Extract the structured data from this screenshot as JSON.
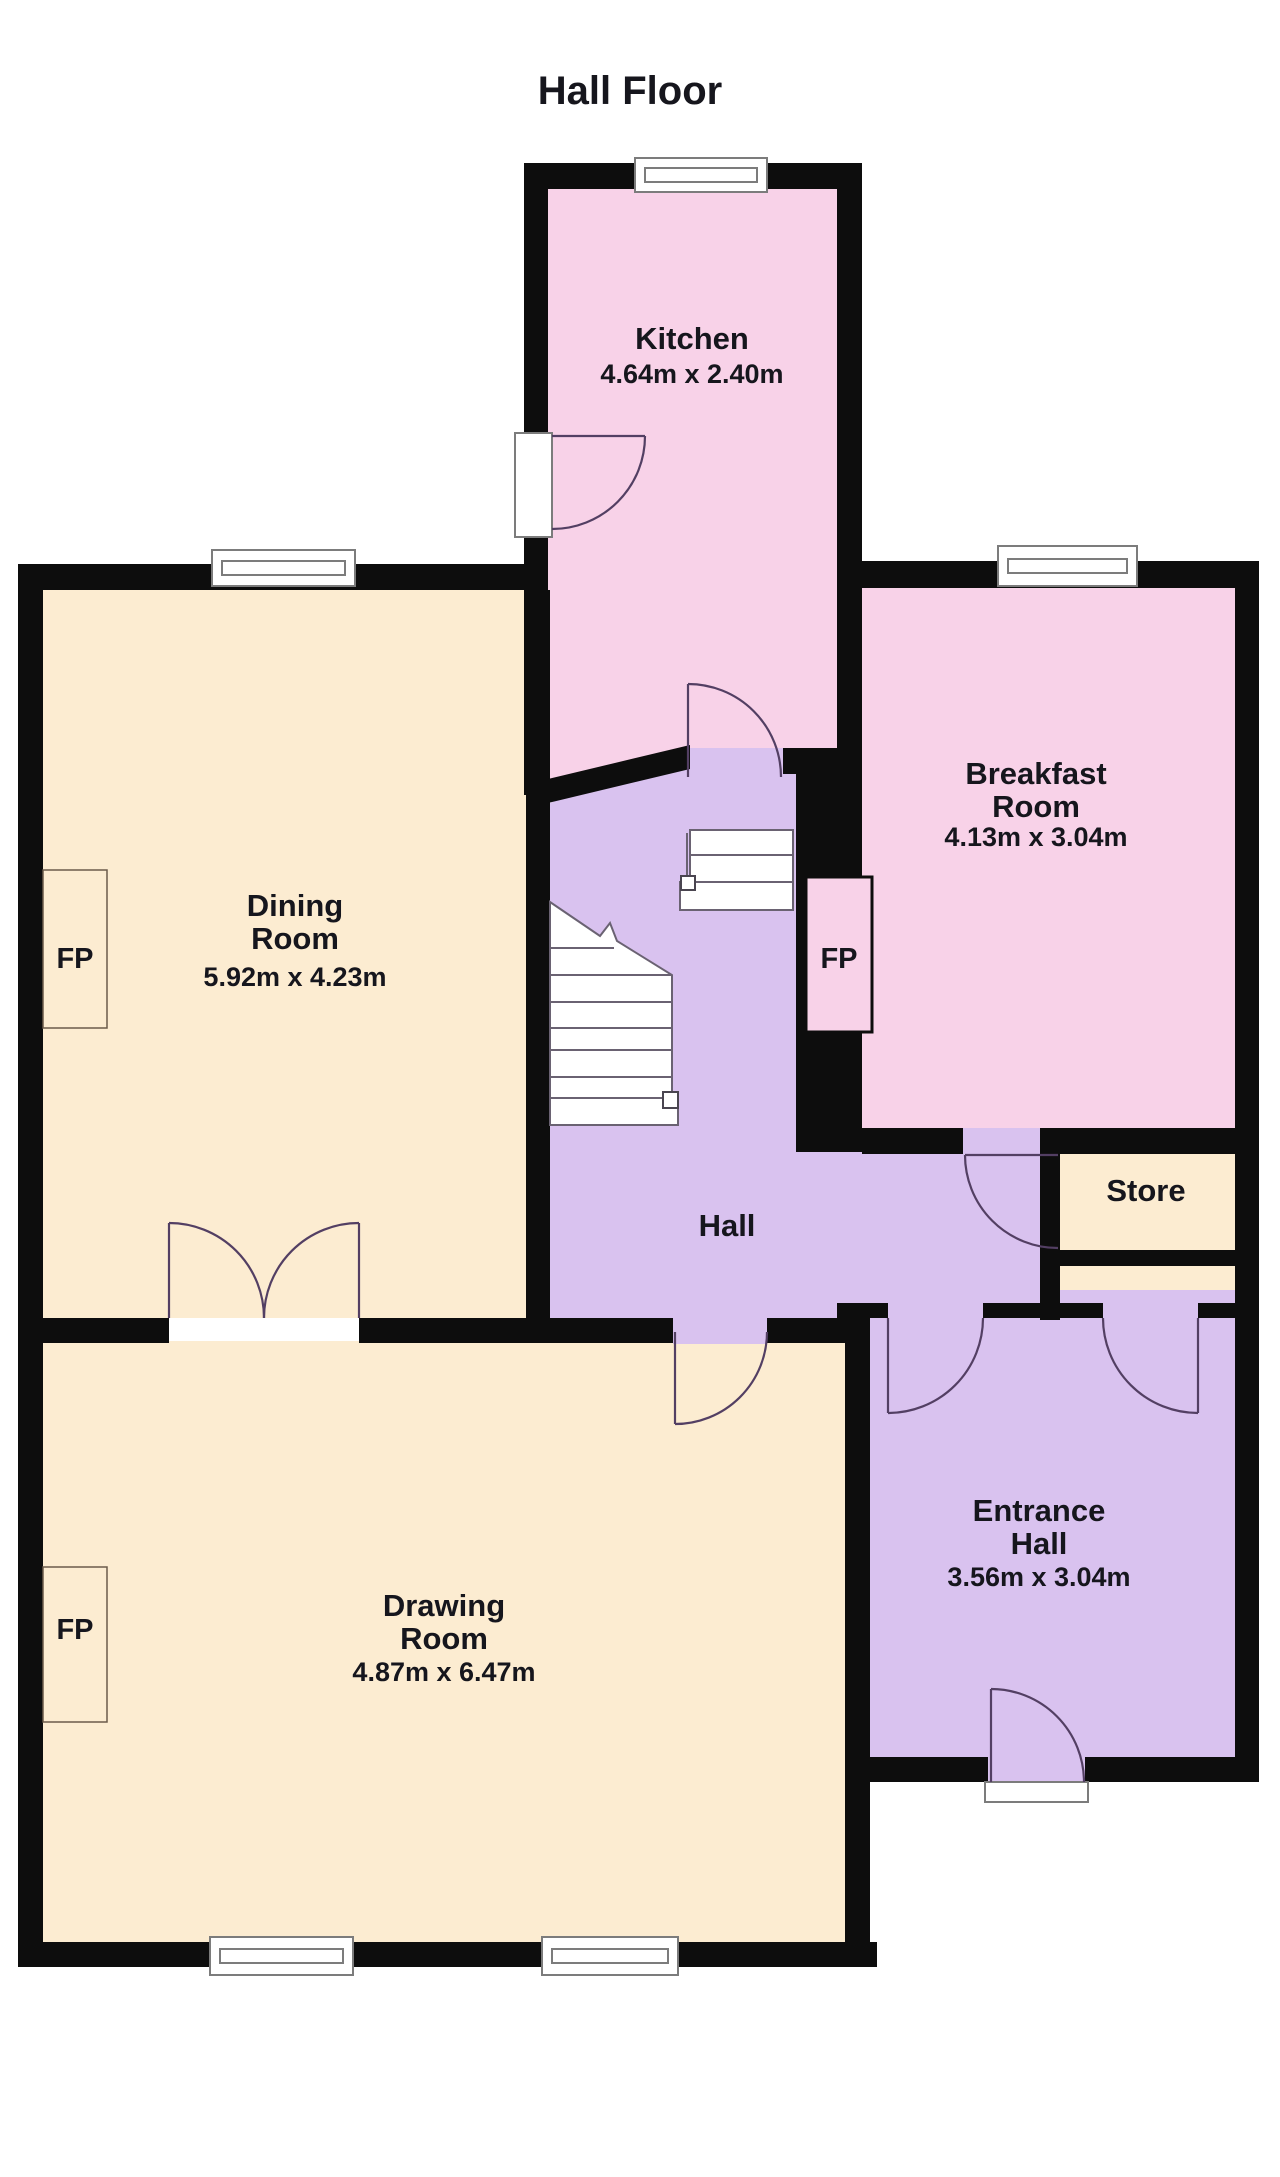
{
  "title": "Hall Floor",
  "rooms": {
    "kitchen": {
      "name": "Kitchen",
      "dims": "4.64m x 2.40m"
    },
    "dining": {
      "name_line1": "Dining",
      "name_line2": "Room",
      "dims": "5.92m x 4.23m"
    },
    "breakfast": {
      "name_line1": "Breakfast",
      "name_line2": "Room",
      "dims": "4.13m x 3.04m"
    },
    "hall": {
      "name": "Hall"
    },
    "store": {
      "name": "Store"
    },
    "entrance": {
      "name_line1": "Entrance",
      "name_line2": "Hall",
      "dims": "3.56m x 3.04m"
    },
    "drawing": {
      "name_line1": "Drawing",
      "name_line2": "Room",
      "dims": "4.87m x 6.47m"
    }
  },
  "fireplace_label": "FP",
  "colors": {
    "background": "#ffffff",
    "wall": "#0d0d0d",
    "pink_room": "#f8d2e8",
    "lavender_room": "#d9c2ef",
    "cream_room": "#fcecd1",
    "door_swing": "#533f63",
    "window_frame": "#7c7c7c",
    "stair_outline": "#6a6272",
    "label_text": "#16161d"
  }
}
